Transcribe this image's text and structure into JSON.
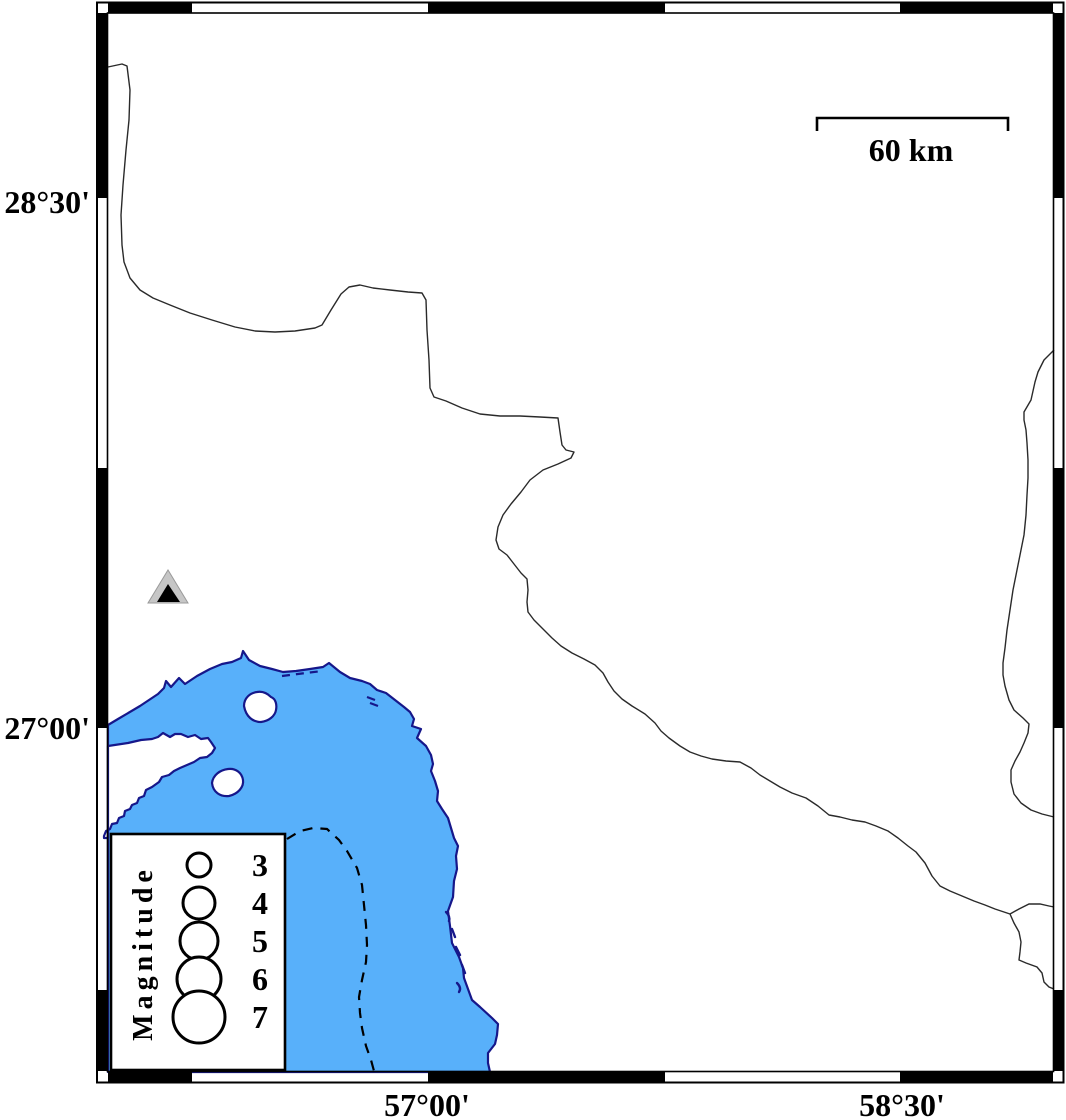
{
  "figure": {
    "kind": "coastline-earthquake-map",
    "description": "Mercator map frame with fancy alternating black/white border, coastline and sea fill, province boundary lines, one station triangle, magnitude legend and scale bar"
  },
  "axis_labels": {
    "left": [
      "28°30'",
      "27°00'"
    ],
    "bottom": [
      "57°00'",
      "58°30'"
    ]
  },
  "scale_bar": {
    "label": "60 km"
  },
  "legend": {
    "title": "Magnitude",
    "items": [
      {
        "label": "3",
        "radius_px": 12
      },
      {
        "label": "4",
        "radius_px": 16
      },
      {
        "label": "5",
        "radius_px": 19
      },
      {
        "label": "6",
        "radius_px": 22
      },
      {
        "label": "7",
        "radius_px": 26
      }
    ]
  },
  "markers": {
    "station_triangle": {
      "outer_fill": "#c6c6c6",
      "inner_fill": "#000000"
    }
  },
  "colors": {
    "water": "#58b0fa",
    "coastline": "#16178a",
    "boundary_line": "#2a2a2a",
    "frame": "#000000",
    "land": "#ffffff"
  }
}
